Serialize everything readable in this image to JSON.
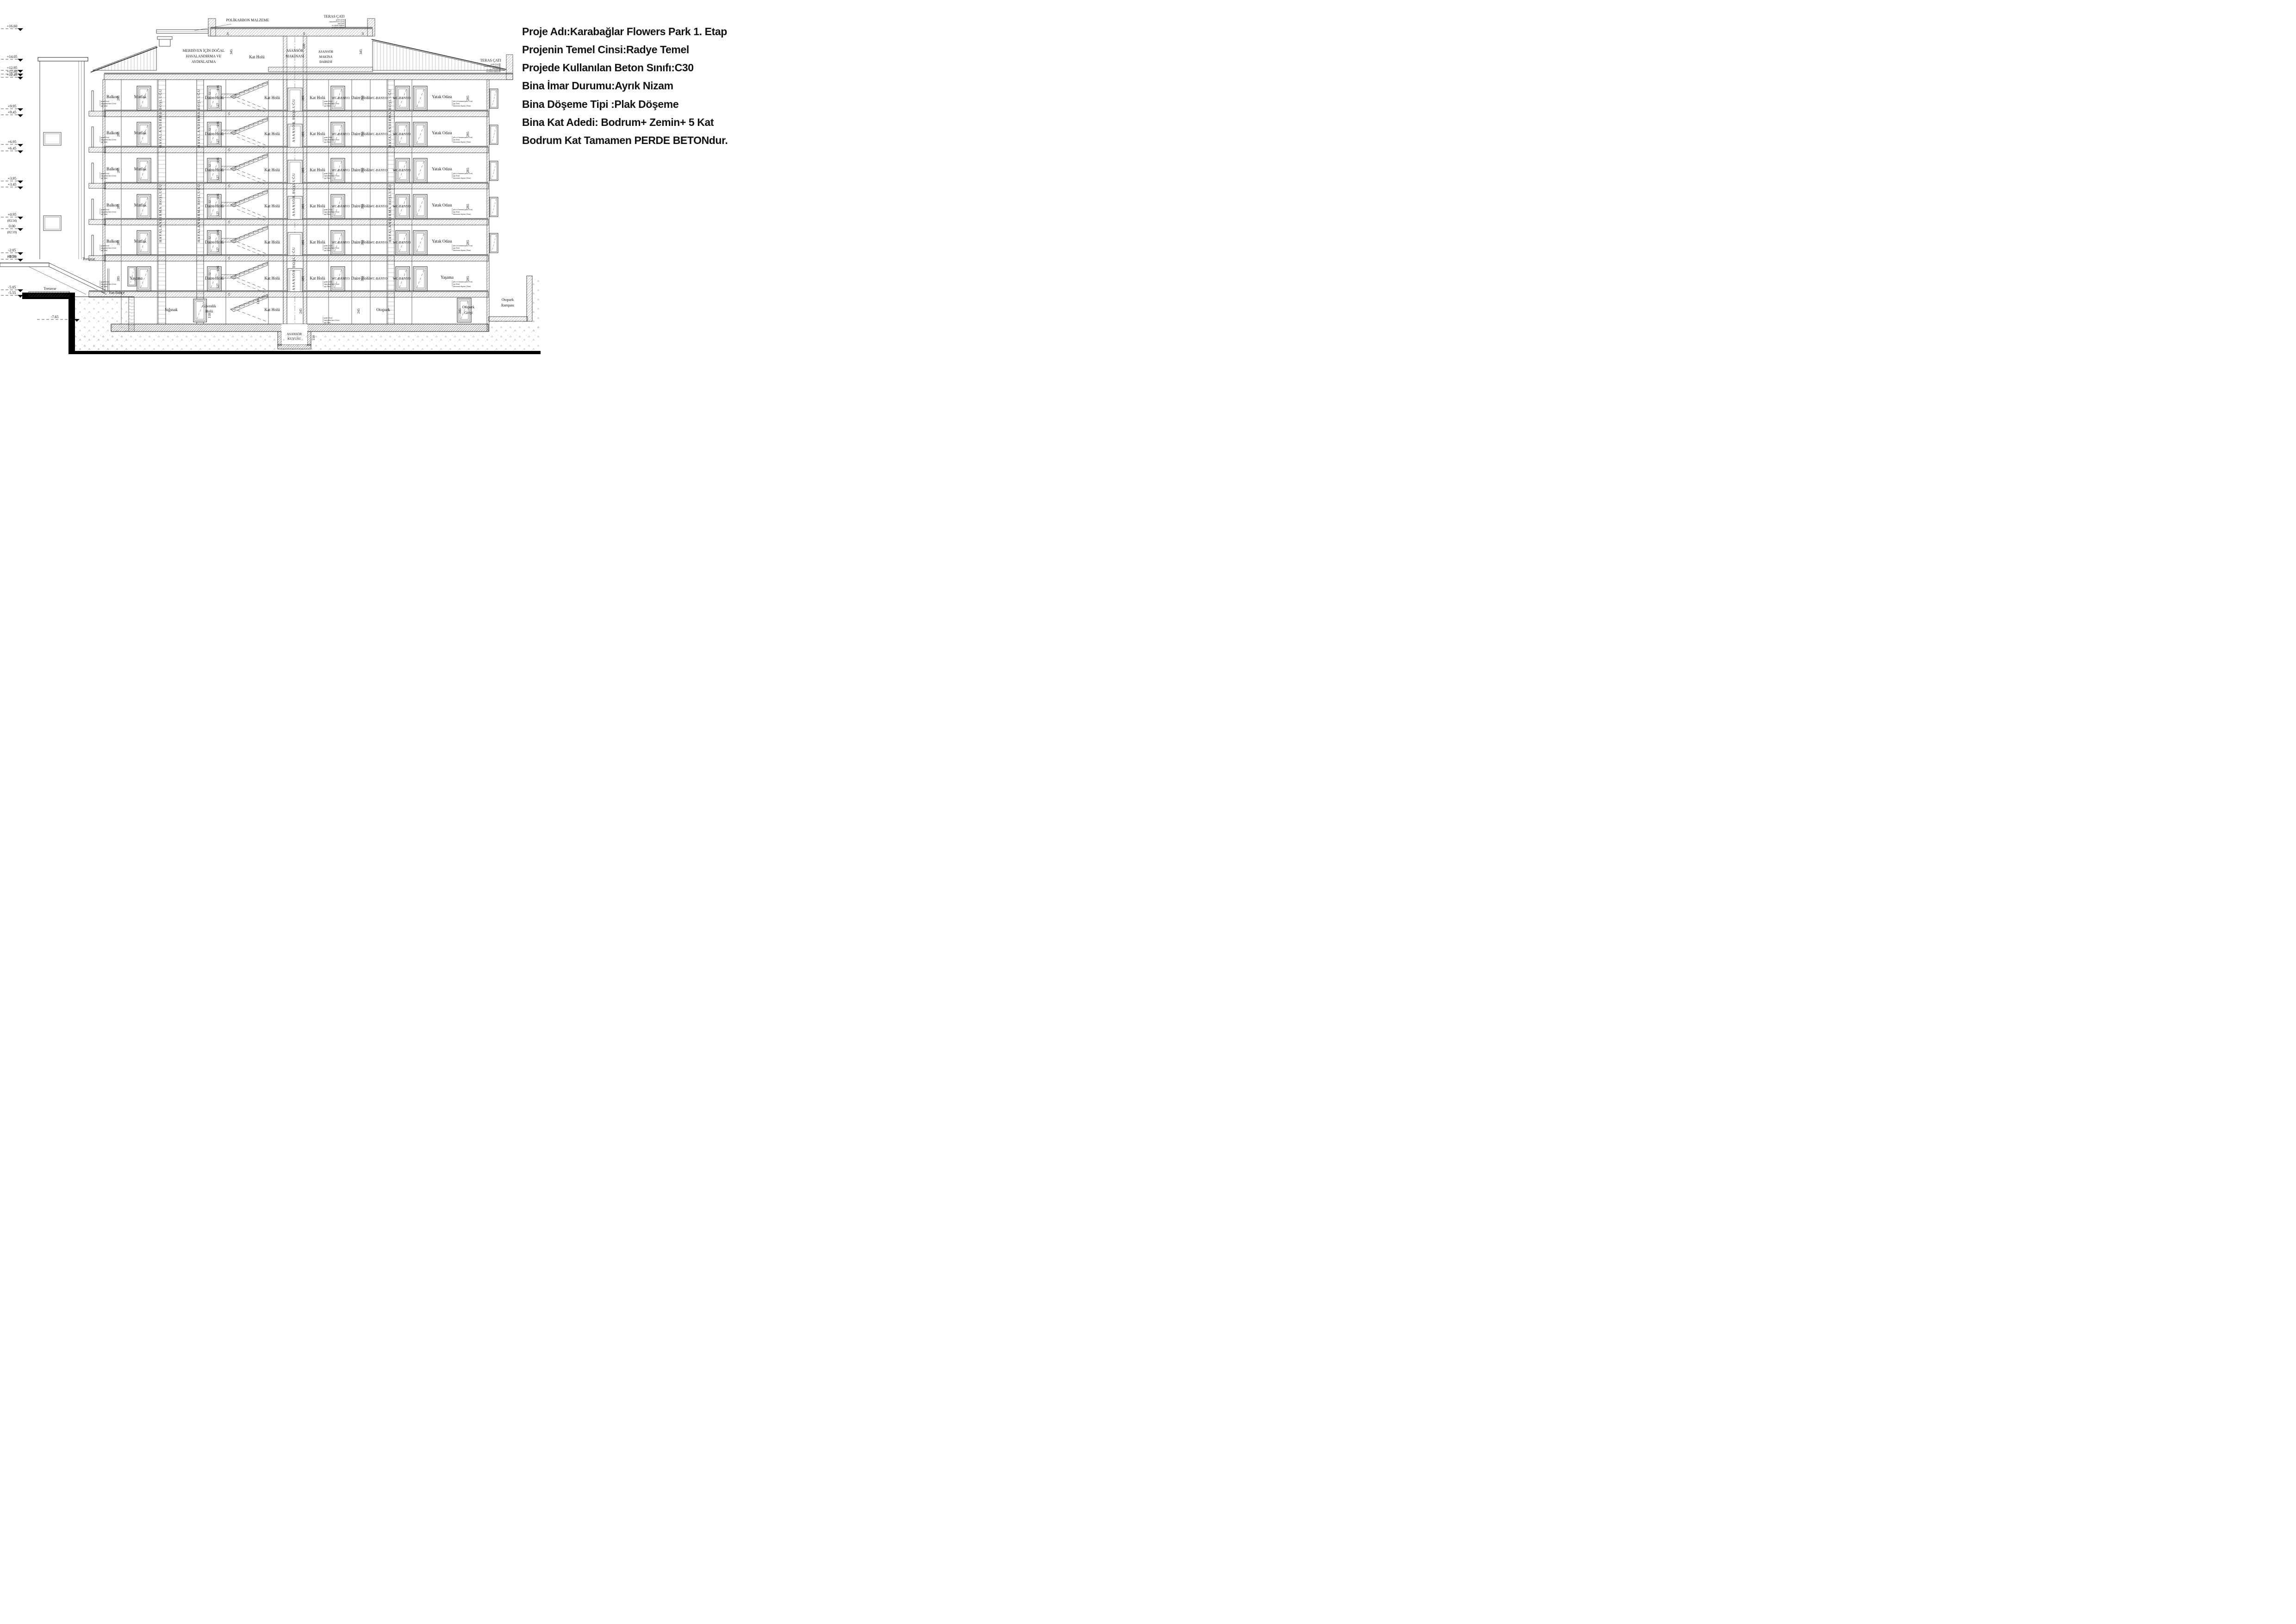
{
  "info_panel": {
    "lines": [
      "Proje Adı:Karabağlar Flowers Park 1. Etap",
      "Projenin Temel Cinsi:Radye Temel",
      "Projede Kullanılan Beton Sınıfı:C30",
      "Bina İmar Durumu:Ayrık Nizam",
      "Bina Döşeme Tipi :Plak Döşeme",
      "Bina Kat Adedi: Bodrum+ Zemin+ 5 Kat",
      "Bodrum Kat Tamamen PERDE BETONdur."
    ]
  },
  "roof": {
    "teras_cati": "TERAS ÇATI",
    "polikarbon": "POLİKARBON MALZEME",
    "merdiven": [
      "MERDİVEN İÇİN DOĞAL",
      "HAVALANDIRMA VE",
      "AYDINLATMA"
    ],
    "asansor_makinasi": [
      "ASANSÖR",
      "MAKİNASI"
    ],
    "makina_dairesi": [
      "ASANSÖR",
      "MAKİNA",
      "DAİRESİ"
    ],
    "teras_layers": [
      "granit (2cm)",
      "yapıştırma harcı (2cm)",
      "şap (5cm)",
      "su yalıtım tabakası",
      "ısı yalıtım tabakası"
    ]
  },
  "rooms": {
    "balkon": "Balkon",
    "mutfak": "Mutfak",
    "yatak_odasi": "Yatak Odası",
    "yasama": "Yaşama",
    "daire_holu": "Daire Holü",
    "kat_holu": "Kat Holü",
    "wc_banyo": "WC-BANYO",
    "siginak": "Sığınak",
    "guvenlik": [
      "Güvenlik",
      "Holü"
    ],
    "otopark": "Otopark",
    "otopark_girisi": [
      "Otopark",
      "Girişi"
    ],
    "otopark_rampasi": [
      "Otopark",
      "Rampası"
    ],
    "asansor_kuyusu": [
      "ASANSÖR",
      "KUYUSU"
    ],
    "havalandirma": "HAVALANDIRMA BOŞLUĞU",
    "asansor_boslugu": "ASANSÖR BOŞLUĞU",
    "tretuvar": "Tretuvar",
    "yan_bahce": "Yan Bahçe"
  },
  "layers": {
    "granit": [
      "granit (2cm)",
      "yapıştırma harcı (2cm)",
      "şap (5cm)"
    ],
    "silte": [
      "şilte ve laminant parke (1cm)",
      "şap (5cm)",
      "betonarme döşeme (16cm)"
    ]
  },
  "dims": {
    "d285": "285",
    "d15": "15",
    "d146": "146",
    "d127": "127",
    "d12": "12",
    "d20": "20",
    "d220": "220",
    "d345": "345",
    "d110": "110",
    "d123": "123",
    "d245": "245",
    "d150": "150"
  },
  "elevations": [
    {
      "v": "+16.60"
    },
    {
      "v": "+14.05"
    },
    {
      "v": "+12.95"
    },
    {
      "v": "+12.80"
    },
    {
      "v": "+12.45"
    },
    {
      "v": "+9.95"
    },
    {
      "v": "+9.45"
    },
    {
      "v": "+6.95"
    },
    {
      "v": "+6.45"
    },
    {
      "v": "+3.95"
    },
    {
      "v": "+3.45"
    },
    {
      "v": "+0.95",
      "alt": "(83.54)"
    },
    {
      "v": "0.00",
      "alt": "(82.59)"
    },
    {
      "v": "-2.05",
      "alt": "(80.54)"
    },
    {
      "v": "-2.55"
    },
    {
      "v": "-5.05"
    },
    {
      "v": "-5.55"
    },
    {
      "v": "-7.65"
    }
  ]
}
